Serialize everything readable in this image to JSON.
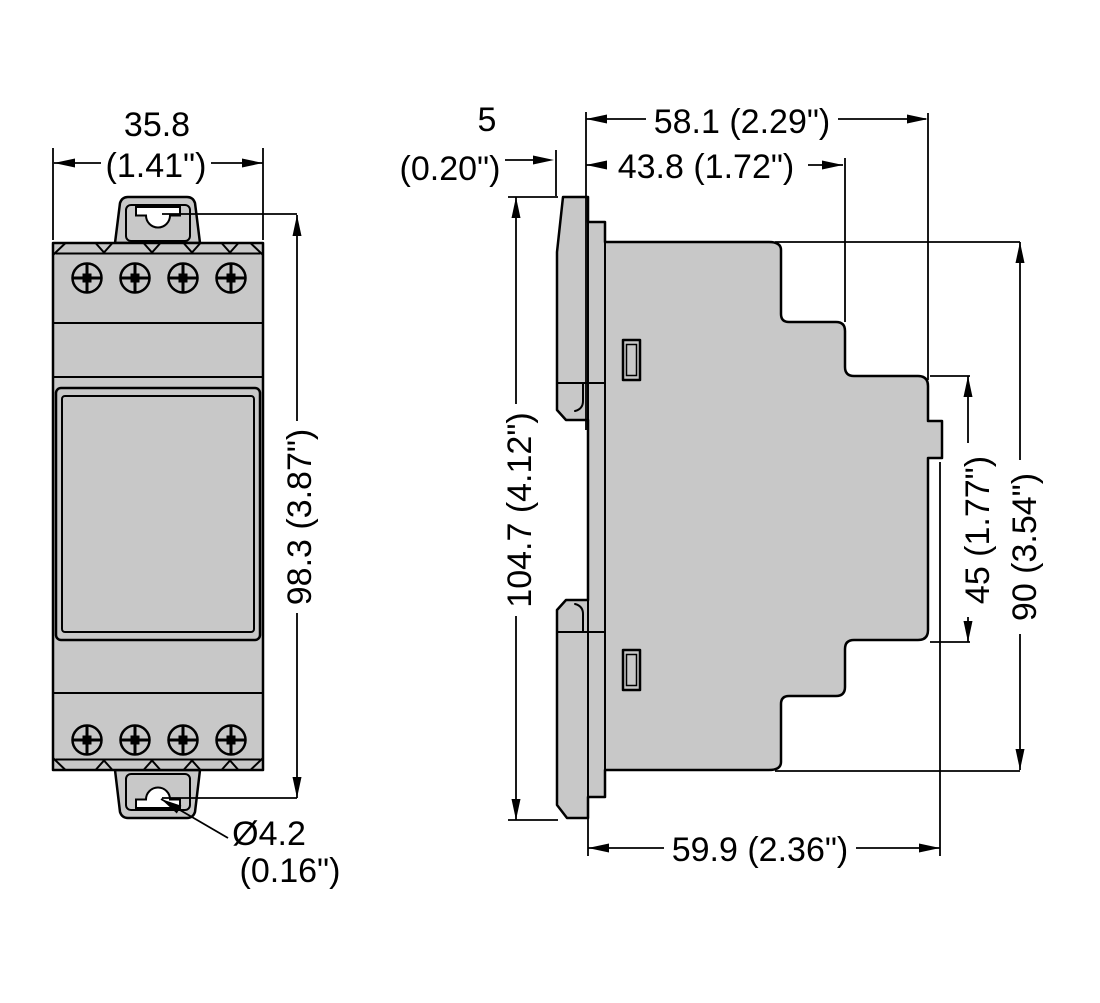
{
  "drawing": {
    "title": "device-dimension-drawing",
    "front_view": {
      "width_mm": "35.8",
      "width_in": "(1.41\")",
      "height": "98.3 (3.87\")",
      "hole_mm": "Ø4.2",
      "hole_in": "(0.16\")"
    },
    "side_view": {
      "tab_depth_mm": "5",
      "tab_depth_in": "(0.20\")",
      "depth_total": "58.1 (2.29\")",
      "depth_upper": "43.8 (1.72\")",
      "height_total": "104.7 (4.12\")",
      "height_front": "45 (1.77\")",
      "height_body": "90 (3.54\")",
      "depth_lower": "59.9 (2.36\")"
    },
    "colors": {
      "body_fill": "#c8c8c8",
      "line": "#000000",
      "background": "#ffffff"
    }
  }
}
